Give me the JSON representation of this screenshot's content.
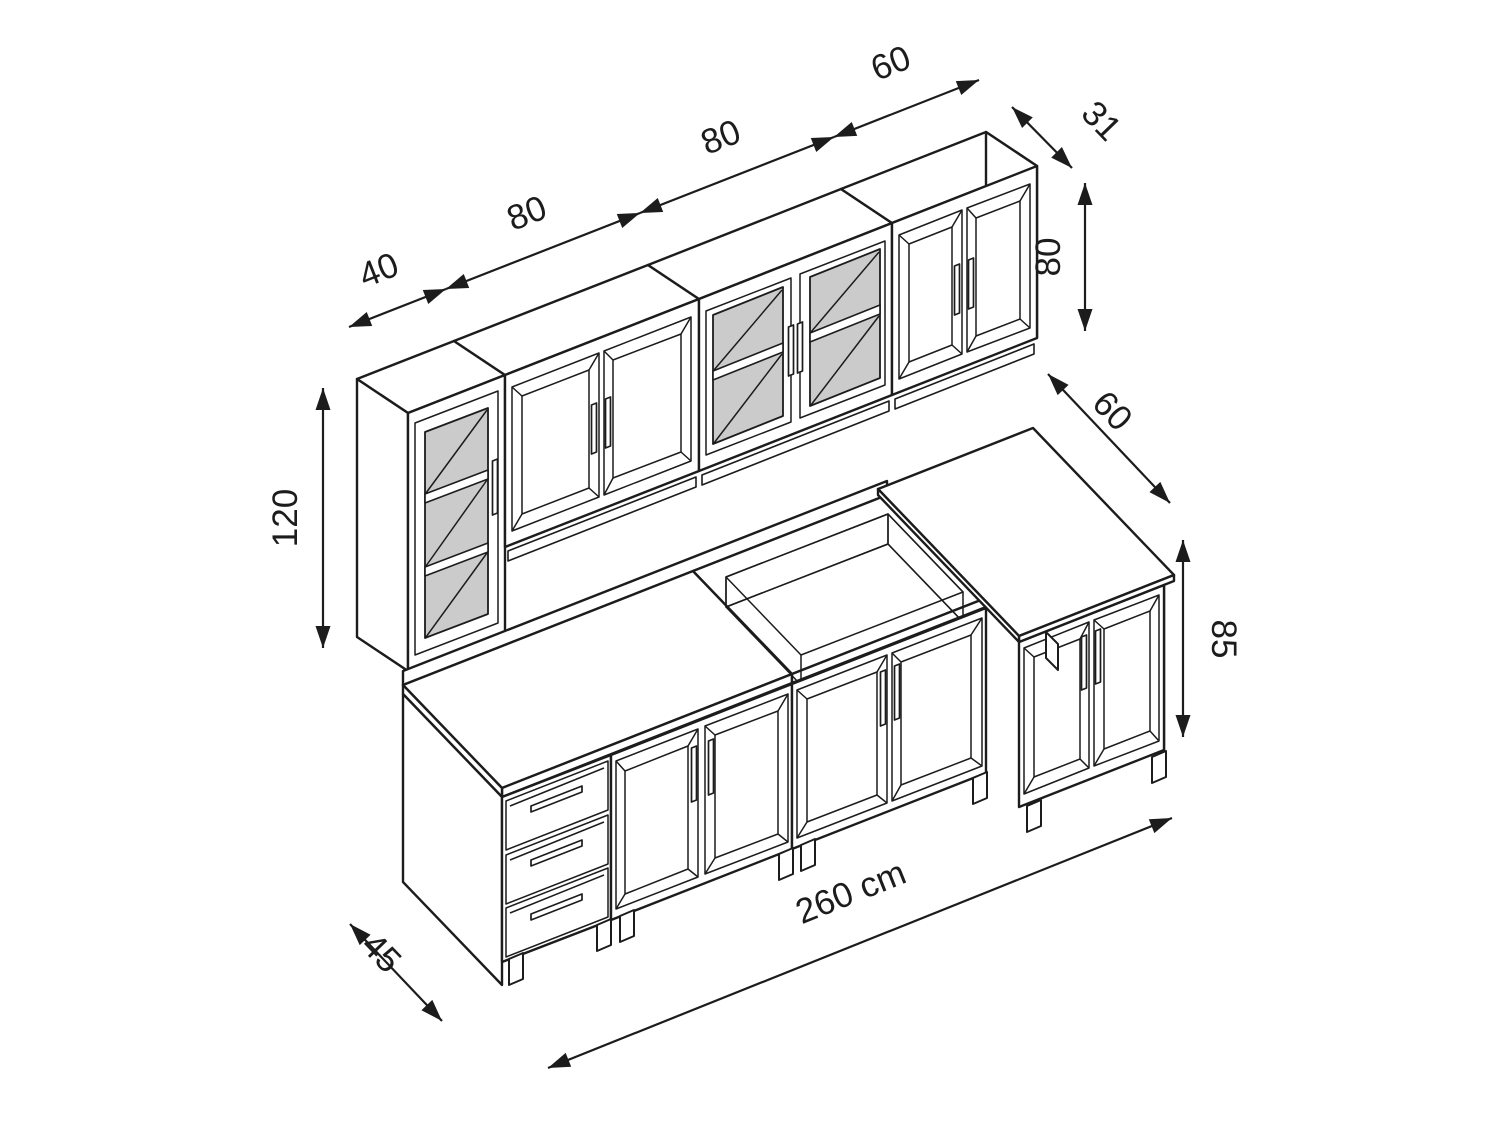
{
  "drawing": {
    "kind": "isometric dimensional drawing",
    "subject": "kitchen cabinet set"
  },
  "colors": {
    "line": "#1c1c1c",
    "glass": "#cbcbcb",
    "background": "#ffffff"
  },
  "dims": {
    "w_tall": "40",
    "w_wall_left": "80",
    "w_wall_glass": "80",
    "w_wall_right": "60",
    "d_wall": "31",
    "h_wall": "80",
    "h_tall": "120",
    "d_base_right": "60",
    "h_base": "85",
    "d_base_left": "45",
    "total_length": "260 cm"
  }
}
